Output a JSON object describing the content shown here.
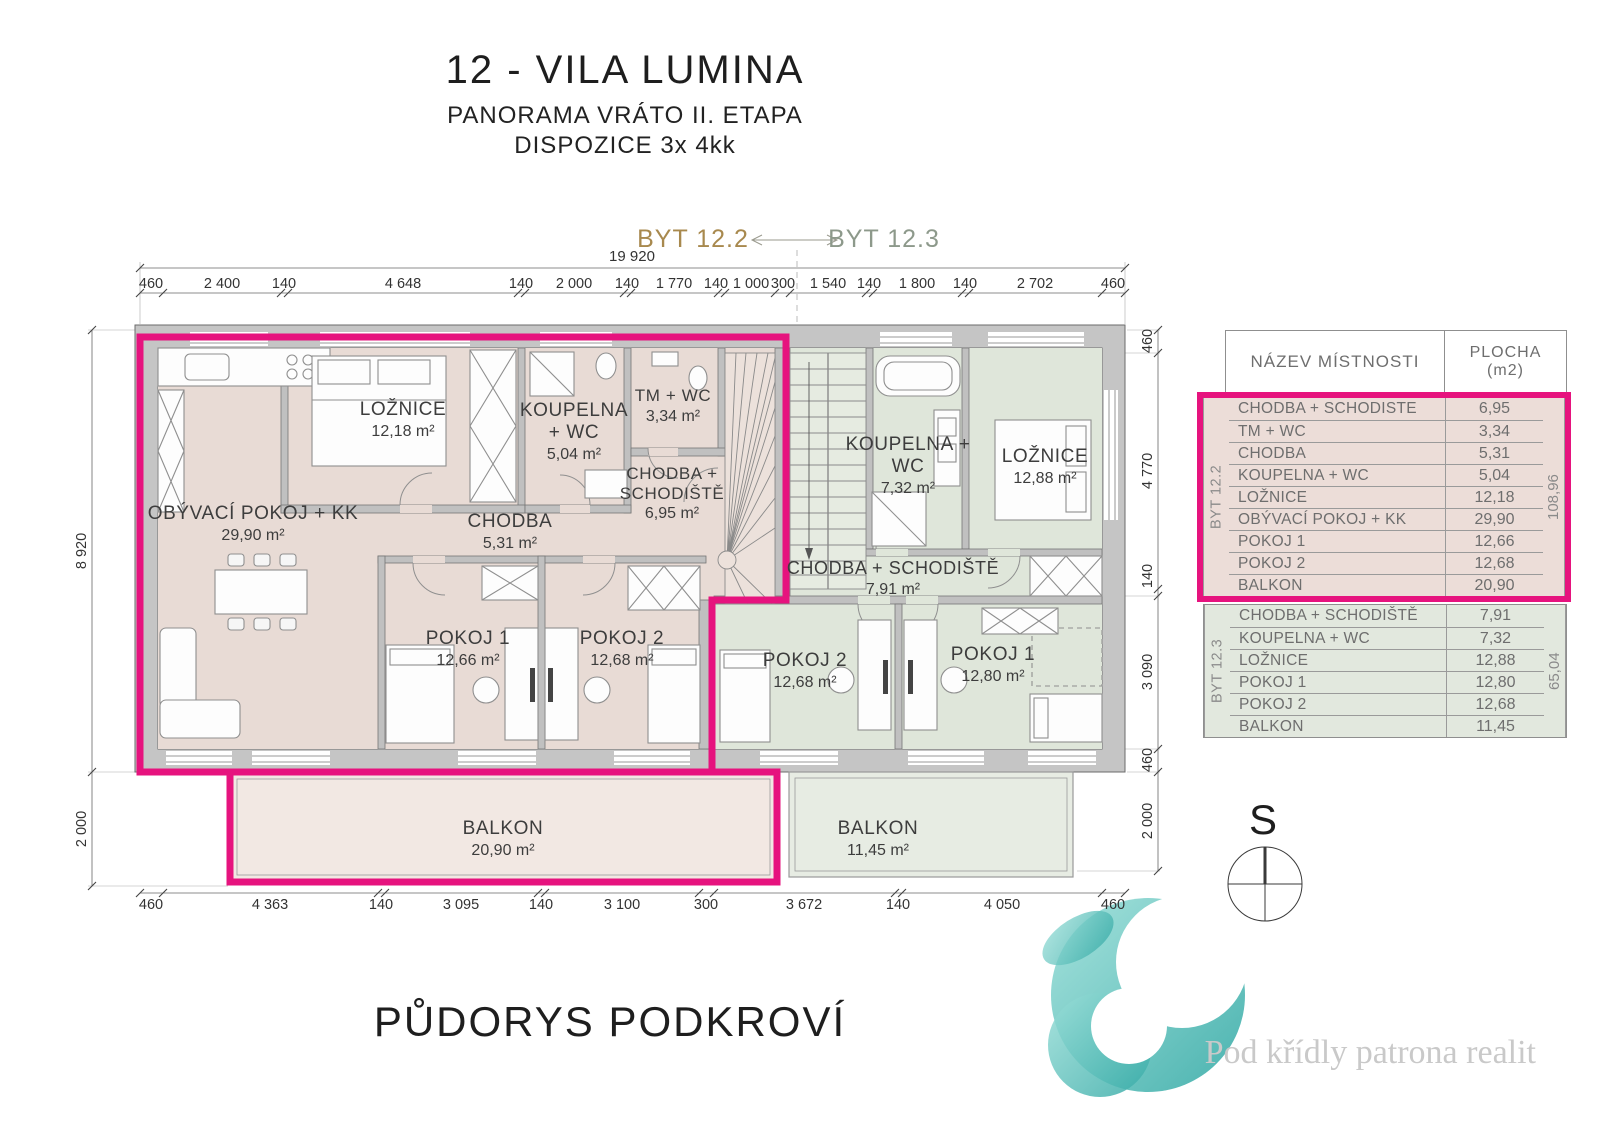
{
  "header": {
    "title": "12 - VILA LUMINA",
    "subtitle1": "PANORAMA VRÁTO II. ETAPA",
    "subtitle2": "DISPOZICE 3x 4kk"
  },
  "plan_title": "PŮDORYS PODKROVÍ",
  "units": {
    "left_label": "BYT 12.2",
    "right_label": "BYT 12.3"
  },
  "compass": {
    "label": "S"
  },
  "watermark": "Pod křídly patrona realit",
  "colors": {
    "accent_pink": "#e6137e",
    "unit122_fill": "#e8dbd5",
    "unit123_fill": "#dfe6da",
    "unit122_label": "#a8894e",
    "unit123_label": "#8d998b",
    "wall_gray": "#c5c5c5"
  },
  "rooms": [
    {
      "name": "LOŽNICE",
      "area": "12,18 m²"
    },
    {
      "name": "KOUPELNA + WC",
      "area": "5,04 m²"
    },
    {
      "name": "TM + WC",
      "area": "3,34 m²"
    },
    {
      "name": "CHODBA + SCHODIŠTĚ",
      "area": "6,95 m²"
    },
    {
      "name": "OBÝVACÍ POKOJ + KK",
      "area": "29,90 m²"
    },
    {
      "name": "CHODBA",
      "area": "5,31 m²"
    },
    {
      "name": "POKOJ 1",
      "area": "12,66 m²"
    },
    {
      "name": "POKOJ 2",
      "area": "12,68 m²"
    },
    {
      "name": "BALKON",
      "area": "20,90 m²"
    },
    {
      "name": "KOUPELNA + WC",
      "area": "7,32 m²"
    },
    {
      "name": "LOŽNICE",
      "area": "12,88 m²"
    },
    {
      "name": "CHODBA + SCHODIŠTĚ",
      "area": "7,91 m²"
    },
    {
      "name": "POKOJ 2",
      "area": "12,68 m²"
    },
    {
      "name": "POKOJ 1",
      "area": "12,80 m²"
    },
    {
      "name": "BALKON",
      "area": "11,45 m²"
    }
  ],
  "dims": {
    "top_total": "19 920",
    "top": [
      "460",
      "2 400",
      "140",
      "4 648",
      "140",
      "2 000",
      "140",
      "1 770",
      "140",
      "1 000",
      "300",
      "1 540",
      "140",
      "1 800",
      "140",
      "2 702",
      "460"
    ],
    "bottom": [
      "460",
      "4 363",
      "140",
      "3 095",
      "140",
      "3 100",
      "300",
      "3 672",
      "140",
      "4 050",
      "460"
    ],
    "left": [
      "8 920",
      "2 000"
    ],
    "right": [
      "460",
      "4 770",
      "140",
      "3 090",
      "460",
      "2 000"
    ]
  },
  "table": {
    "header": {
      "name_col": "NÁZEV MÍSTNOSTI",
      "area_col_line1": "PLOCHA",
      "area_col_line2": "(m2)"
    },
    "groups": [
      {
        "label": "BYT 12.2",
        "total": "108,96",
        "rows": [
          {
            "name": "CHODBA + SCHODISTE",
            "value": "6,95"
          },
          {
            "name": "TM + WC",
            "value": "3,34"
          },
          {
            "name": "CHODBA",
            "value": "5,31"
          },
          {
            "name": "KOUPELNA + WC",
            "value": "5,04"
          },
          {
            "name": "LOŽNICE",
            "value": "12,18"
          },
          {
            "name": "OBÝVACÍ POKOJ + KK",
            "value": "29,90"
          },
          {
            "name": "POKOJ 1",
            "value": "12,66"
          },
          {
            "name": "POKOJ 2",
            "value": "12,68"
          },
          {
            "name": "BALKON",
            "value": "20,90"
          }
        ]
      },
      {
        "label": "BYT 12.3",
        "total": "65,04",
        "rows": [
          {
            "name": "CHODBA + SCHODIŠTĚ",
            "value": "7,91"
          },
          {
            "name": "KOUPELNA + WC",
            "value": "7,32"
          },
          {
            "name": "LOŽNICE",
            "value": "12,88"
          },
          {
            "name": "POKOJ 1",
            "value": "12,80"
          },
          {
            "name": "POKOJ 2",
            "value": "12,68"
          },
          {
            "name": "BALKON",
            "value": "11,45"
          }
        ]
      }
    ]
  }
}
